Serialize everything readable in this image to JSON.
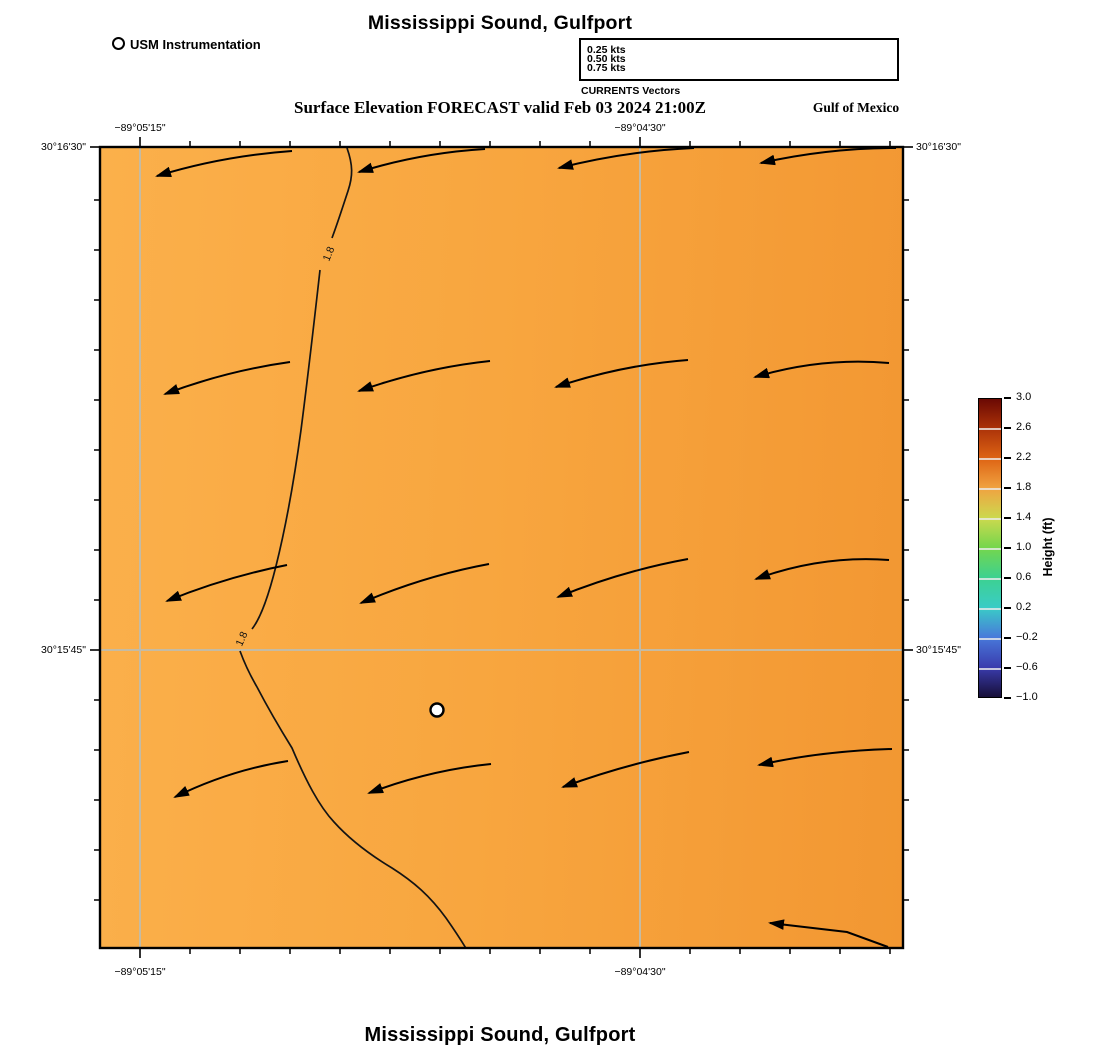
{
  "titles": {
    "top": "Mississippi Sound, Gulfport",
    "subtitle": "Surface Elevation FORECAST valid Feb 03 2024 21:00Z",
    "region_label": "Gulf of Mexico",
    "bottom": "Mississippi Sound, Gulfport"
  },
  "usm_legend": {
    "label": "USM Instrumentation"
  },
  "vector_legend": {
    "title": "CURRENTS Vectors",
    "items": [
      {
        "label": "0.25 kts",
        "length_px": 85
      },
      {
        "label": "0.50 kts",
        "length_px": 166
      },
      {
        "label": "0.75 kts",
        "length_px": 246
      }
    ],
    "row_y": [
      51,
      60,
      69
    ],
    "tip_x": 891
  },
  "axes": {
    "lon": [
      {
        "label": "−89°05'15\"",
        "x": 140
      },
      {
        "label": "−89°04'30\"",
        "x": 640
      }
    ],
    "lat": [
      {
        "label": "30°16'30\"",
        "y": 147
      },
      {
        "label": "30°15'45\"",
        "y": 650
      }
    ]
  },
  "colorbar": {
    "label": "Height (ft)",
    "ticks": [
      "3.0",
      "2.6",
      "2.2",
      "1.8",
      "1.4",
      "1.0",
      "0.6",
      "0.2",
      "−0.2",
      "−0.6",
      "−1.0"
    ],
    "values": [
      3.0,
      2.6,
      2.2,
      1.8,
      1.4,
      1.0,
      0.6,
      0.2,
      -0.2,
      -0.6,
      -1.0
    ],
    "stops": [
      "#6b0903",
      "#ac3309",
      "#de6414",
      "#f0a341",
      "#ccd94e",
      "#74d64d",
      "#3dd190",
      "#3accc6",
      "#4879da",
      "#3a3cae",
      "#170f38"
    ],
    "geometry": {
      "x": 978,
      "y": 398,
      "w": 24,
      "h": 300,
      "tick_step": 30
    }
  },
  "colors": {
    "gridline": "#c4bba4",
    "contour": "#141414",
    "arrow": "#000000",
    "map_orange_light": "#fbb04b",
    "map_orange_dark": "#f29732"
  },
  "chart_data": {
    "type": "vector-field-map",
    "title": "Mississippi Sound, Gulfport",
    "subtitle": "Surface Elevation FORECAST valid Feb 03 2024 21:00Z",
    "field": "surface elevation (ft)",
    "shaded_value_range_ft": [
      1.8,
      2.2
    ],
    "legend_scale_px_per_kt": 330,
    "map_frame_px": {
      "left": 100,
      "top": 147,
      "right": 903,
      "bottom": 948
    },
    "grid": {
      "lon_x": [
        140,
        640
      ],
      "lat_y": [
        650
      ]
    },
    "contour": {
      "value_ft": 1.8,
      "label": "1.8",
      "segments": [
        "M347,148 C353,165 353,176 348,191 C343,206 338,222 332,238",
        "M320,270 C314,323 309,368 301,430 C295,474 287,522 276,566 C268,598 260,619 252,629",
        "M240,651 C244,662 250,675 257,687 C269,710 279,727 292,748 C306,781 319,806 334,822 C352,842 372,856 392,868 C414,882 430,896 446,918 C453,928 461,940 467,950"
      ],
      "labels": [
        {
          "x": 329,
          "y": 254,
          "rot": -68
        },
        {
          "x": 242,
          "y": 639,
          "rot": -66
        }
      ]
    },
    "station": {
      "name": "USM Instrumentation",
      "x": 437,
      "y": 710,
      "r": 6.5
    },
    "vectors": [
      {
        "tail": [
          292,
          151
        ],
        "ctrl": [
          222,
          156
        ],
        "tip": [
          157,
          176
        ]
      },
      {
        "tail": [
          485,
          149
        ],
        "ctrl": [
          420,
          153
        ],
        "tip": [
          359,
          172
        ]
      },
      {
        "tail": [
          694,
          148
        ],
        "ctrl": [
          626,
          151
        ],
        "tip": [
          559,
          168
        ]
      },
      {
        "tail": [
          896,
          148
        ],
        "ctrl": [
          828,
          148
        ],
        "tip": [
          761,
          163
        ]
      },
      {
        "tail": [
          290,
          362
        ],
        "ctrl": [
          226,
          371
        ],
        "tip": [
          165,
          394
        ]
      },
      {
        "tail": [
          490,
          361
        ],
        "ctrl": [
          424,
          368
        ],
        "tip": [
          359,
          391
        ]
      },
      {
        "tail": [
          688,
          360
        ],
        "ctrl": [
          622,
          365
        ],
        "tip": [
          556,
          387
        ]
      },
      {
        "tail": [
          889,
          363
        ],
        "ctrl": [
          822,
          357
        ],
        "tip": [
          755,
          377
        ]
      },
      {
        "tail": [
          287,
          565
        ],
        "ctrl": [
          226,
          577
        ],
        "tip": [
          167,
          601
        ]
      },
      {
        "tail": [
          489,
          564
        ],
        "ctrl": [
          424,
          576
        ],
        "tip": [
          361,
          603
        ]
      },
      {
        "tail": [
          688,
          559
        ],
        "ctrl": [
          622,
          571
        ],
        "tip": [
          558,
          597
        ]
      },
      {
        "tail": [
          889,
          560
        ],
        "ctrl": [
          822,
          555
        ],
        "tip": [
          756,
          579
        ]
      },
      {
        "tail": [
          288,
          761
        ],
        "ctrl": [
          230,
          770
        ],
        "tip": [
          175,
          797
        ]
      },
      {
        "tail": [
          491,
          764
        ],
        "ctrl": [
          430,
          770
        ],
        "tip": [
          369,
          793
        ]
      },
      {
        "tail": [
          689,
          752
        ],
        "ctrl": [
          626,
          764
        ],
        "tip": [
          563,
          787
        ]
      },
      {
        "tail": [
          892,
          749
        ],
        "ctrl": [
          822,
          751
        ],
        "tip": [
          759,
          765
        ]
      },
      {
        "pts": [
          [
            888,
            947
          ],
          [
            847,
            932
          ],
          [
            770,
            923
          ]
        ]
      }
    ],
    "ticks": {
      "lon_minor_start": 190,
      "lon_minor_end": 890,
      "step": 50,
      "lat_minor_start": 200,
      "lat_minor_end": 900
    }
  }
}
